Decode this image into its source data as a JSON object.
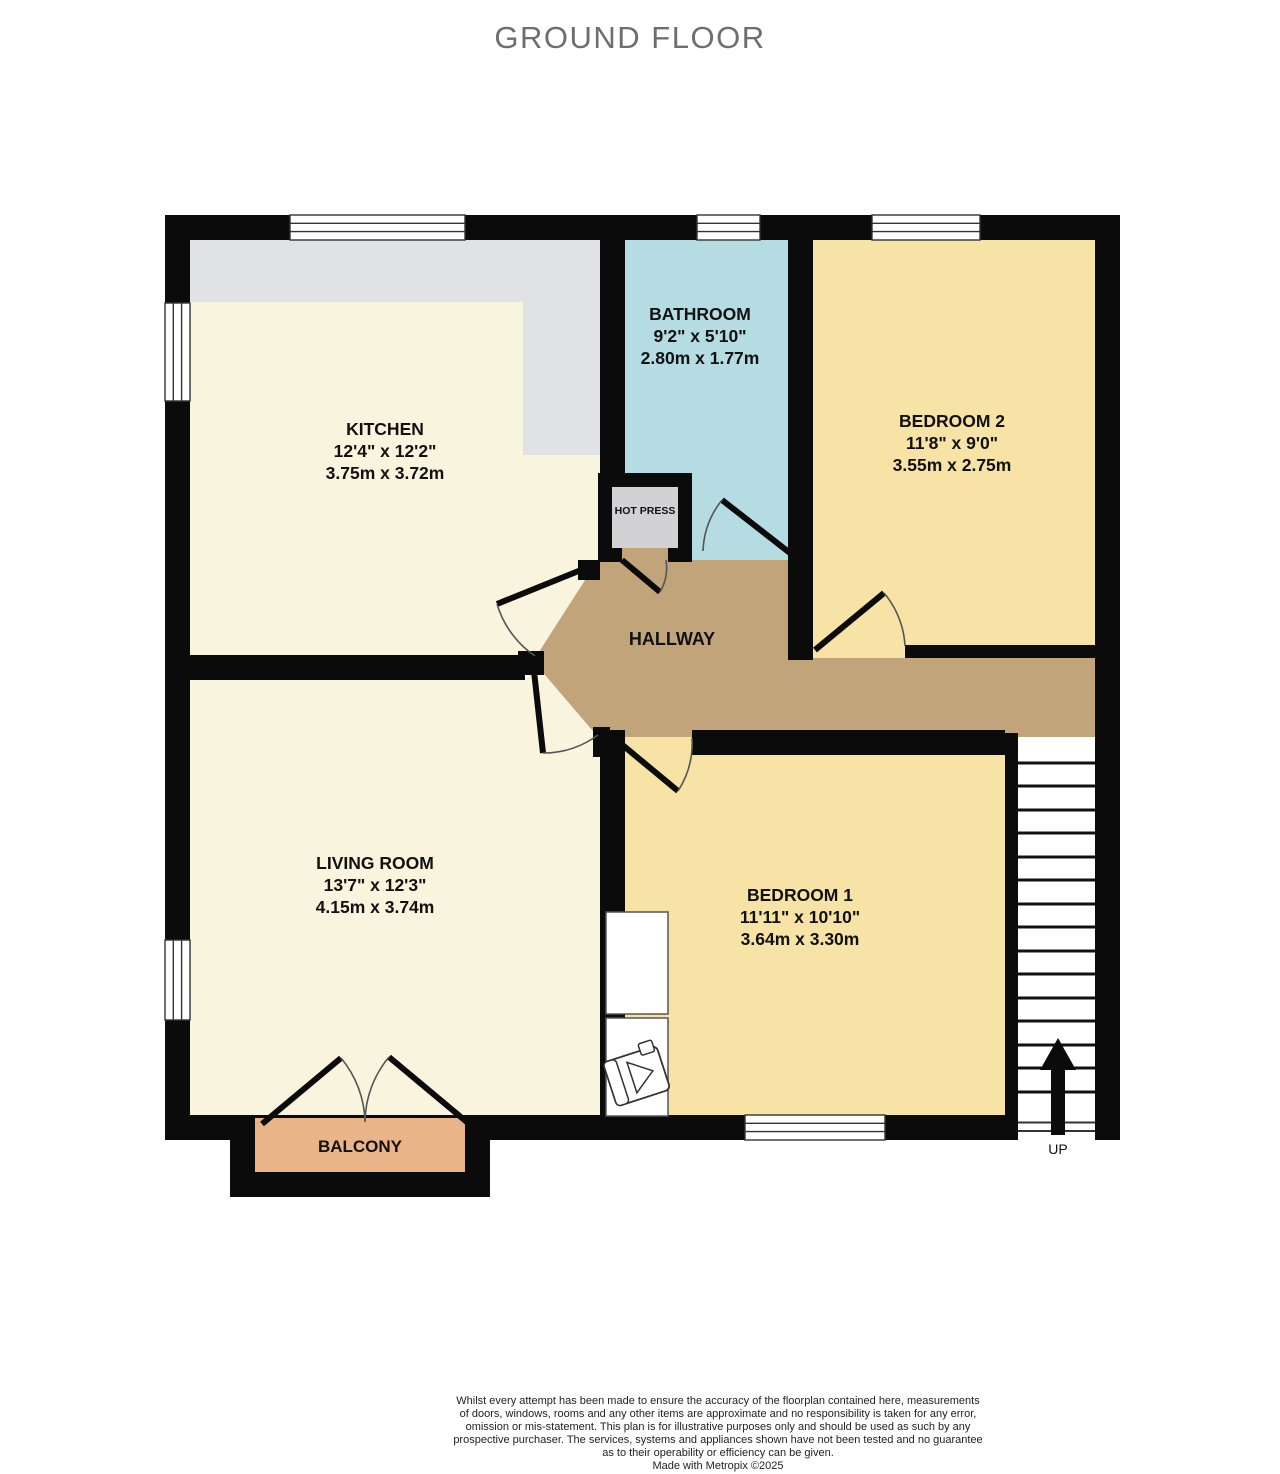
{
  "title": "GROUND FLOOR",
  "rooms": {
    "kitchen": {
      "name": "KITCHEN",
      "imperial": "12'4\" x 12'2\"",
      "metric": "3.75m x 3.72m"
    },
    "bathroom": {
      "name": "BATHROOM",
      "imperial": "9'2\" x 5'10\"",
      "metric": "2.80m x 1.77m"
    },
    "bedroom2": {
      "name": "BEDROOM 2",
      "imperial": "11'8\" x 9'0\"",
      "metric": "3.55m x 2.75m"
    },
    "living_room": {
      "name": "LIVING ROOM",
      "imperial": "13'7\" x 12'3\"",
      "metric": "4.15m x 3.74m"
    },
    "bedroom1": {
      "name": "BEDROOM 1",
      "imperial": "11'11\" x 10'10\"",
      "metric": "3.64m x 3.30m"
    },
    "hallway": {
      "name": "HALLWAY"
    },
    "hot_press": {
      "name": "HOT PRESS"
    },
    "balcony": {
      "name": "BALCONY"
    }
  },
  "stairs": {
    "direction_label": "UP"
  },
  "disclaimer": {
    "lines": [
      "Whilst every attempt has been made to ensure the accuracy of the floorplan contained here, measurements",
      "of doors, windows, rooms and any other items are approximate and no responsibility is taken for any error,",
      "omission or mis-statement. This plan is for illustrative purposes only and should be used as such by any",
      "prospective purchaser. The services, systems and appliances shown have not been tested and no guarantee",
      "as to their operability or efficiency can be given."
    ],
    "made_with": "Made with Metropix ©2025"
  },
  "colors": {
    "wall": "#0b0b0b",
    "cream_floor": "#f8f4dd",
    "yellow_floor": "#f6e3a5",
    "blue_floor": "#b5dce2",
    "hallway_floor": "#c2a47b",
    "balcony_floor": "#e9b488",
    "counter_gray": "#e0e2e6",
    "hot_press_gray": "#d2d2d4",
    "title_text": "#6e6e6e"
  }
}
